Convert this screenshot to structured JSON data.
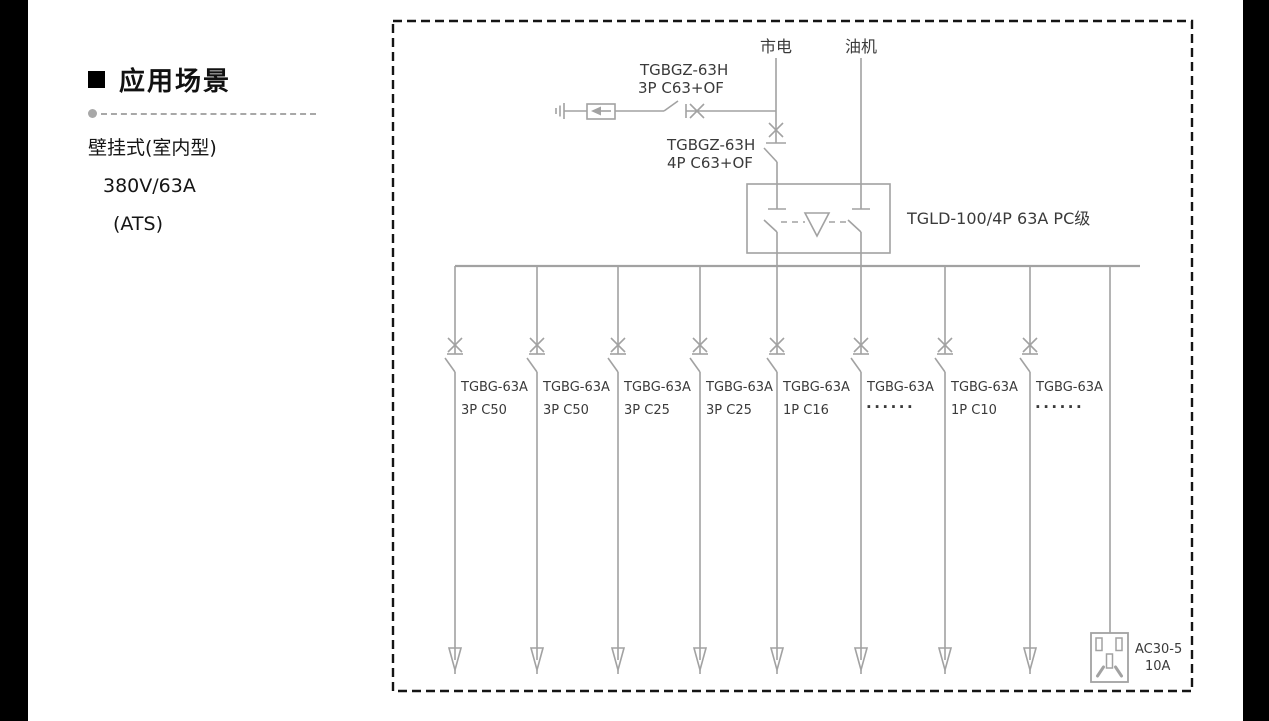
{
  "page": {
    "background": "#ffffff",
    "edge_bar_color": "#000000"
  },
  "sidebar": {
    "title": "应用场景",
    "lines": [
      "壁挂式(室内型)",
      "380V/63A",
      "(ATS)"
    ]
  },
  "diagram": {
    "colors": {
      "line": "#a2a2a2",
      "text": "#3a3a3a",
      "border": "#141414"
    },
    "sources": {
      "mains": "市电",
      "generator": "油机"
    },
    "spd_breaker": {
      "model": "TGBGZ-63H",
      "spec": "3P C63+OF"
    },
    "main_breaker": {
      "model": "TGBGZ-63H",
      "spec": "4P C63+OF"
    },
    "ats": {
      "label": "TGLD-100/4P 63A PC级"
    },
    "branches": [
      {
        "model": "TGBG-63A",
        "spec": "3P C50"
      },
      {
        "model": "TGBG-63A",
        "spec": "3P C50"
      },
      {
        "model": "TGBG-63A",
        "spec": "3P C25"
      },
      {
        "model": "TGBG-63A",
        "spec": "3P C25"
      },
      {
        "model": "TGBG-63A",
        "spec": "1P C16"
      },
      {
        "model": "TGBG-63A",
        "spec": "······",
        "dots": true
      },
      {
        "model": "TGBG-63A",
        "spec": "1P C10"
      },
      {
        "model": "TGBG-63A",
        "spec": "······",
        "dots": true
      }
    ],
    "socket": {
      "model": "AC30-5",
      "rating": "10A"
    }
  }
}
